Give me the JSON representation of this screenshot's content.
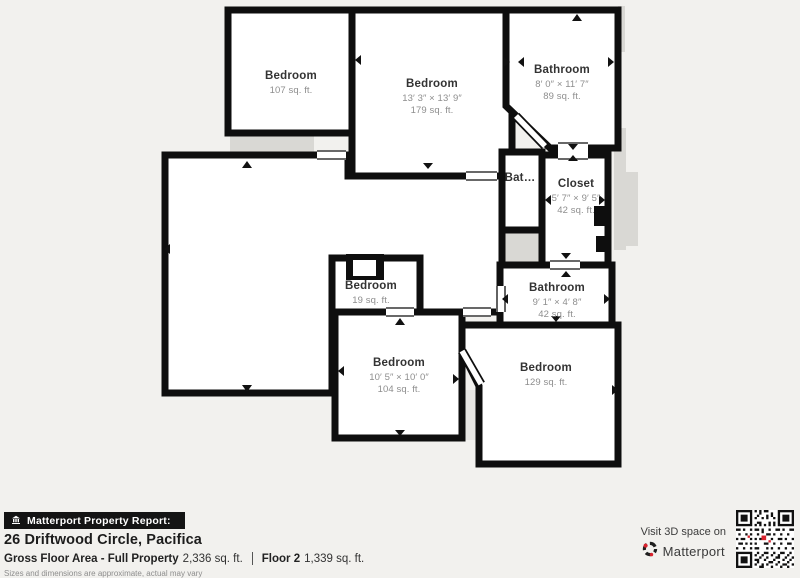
{
  "floorplan": {
    "rooms": [
      {
        "name": "Bedroom",
        "area": "107 sq. ft."
      },
      {
        "name": "Bedroom",
        "dims": "13′ 3″ × 13′ 9″",
        "area": "179 sq. ft."
      },
      {
        "name": "Bathroom",
        "dims": "8′ 0″ × 11′ 7″",
        "area": "89 sq. ft."
      },
      {
        "name": "Bat…"
      },
      {
        "name": "Closet",
        "dims": "5′ 7″ × 9′ 5″",
        "area": "42 sq. ft."
      },
      {
        "name": "Bathroom",
        "dims": "9′ 1″ × 4′ 8″",
        "area": "42 sq. ft."
      },
      {
        "name": "Bedroom",
        "area": "19 sq. ft."
      },
      {
        "name": "Bedroom",
        "dims": "10′ 5″ × 10′ 0″",
        "area": "104 sq. ft."
      },
      {
        "name": "Bedroom",
        "area": "129 sq. ft."
      }
    ]
  },
  "footer": {
    "report_label": "Matterport Property Report:",
    "address": "26 Driftwood Circle, Pacifica",
    "gross_label": "Gross Floor Area - Full Property",
    "gross_value": "2,336 sq. ft.",
    "floor_label": "Floor 2",
    "floor_value": "1,339 sq. ft.",
    "disclaimer": "Sizes and dimensions are approximate, actual may vary",
    "visit_label": "Visit 3D space on",
    "brand": "Matterport"
  },
  "colors": {
    "wall": "#0e0e0e",
    "background": "#f2f1ee",
    "adjacent_gray": "#d9d8d4",
    "accent_red": "#d9232e"
  }
}
